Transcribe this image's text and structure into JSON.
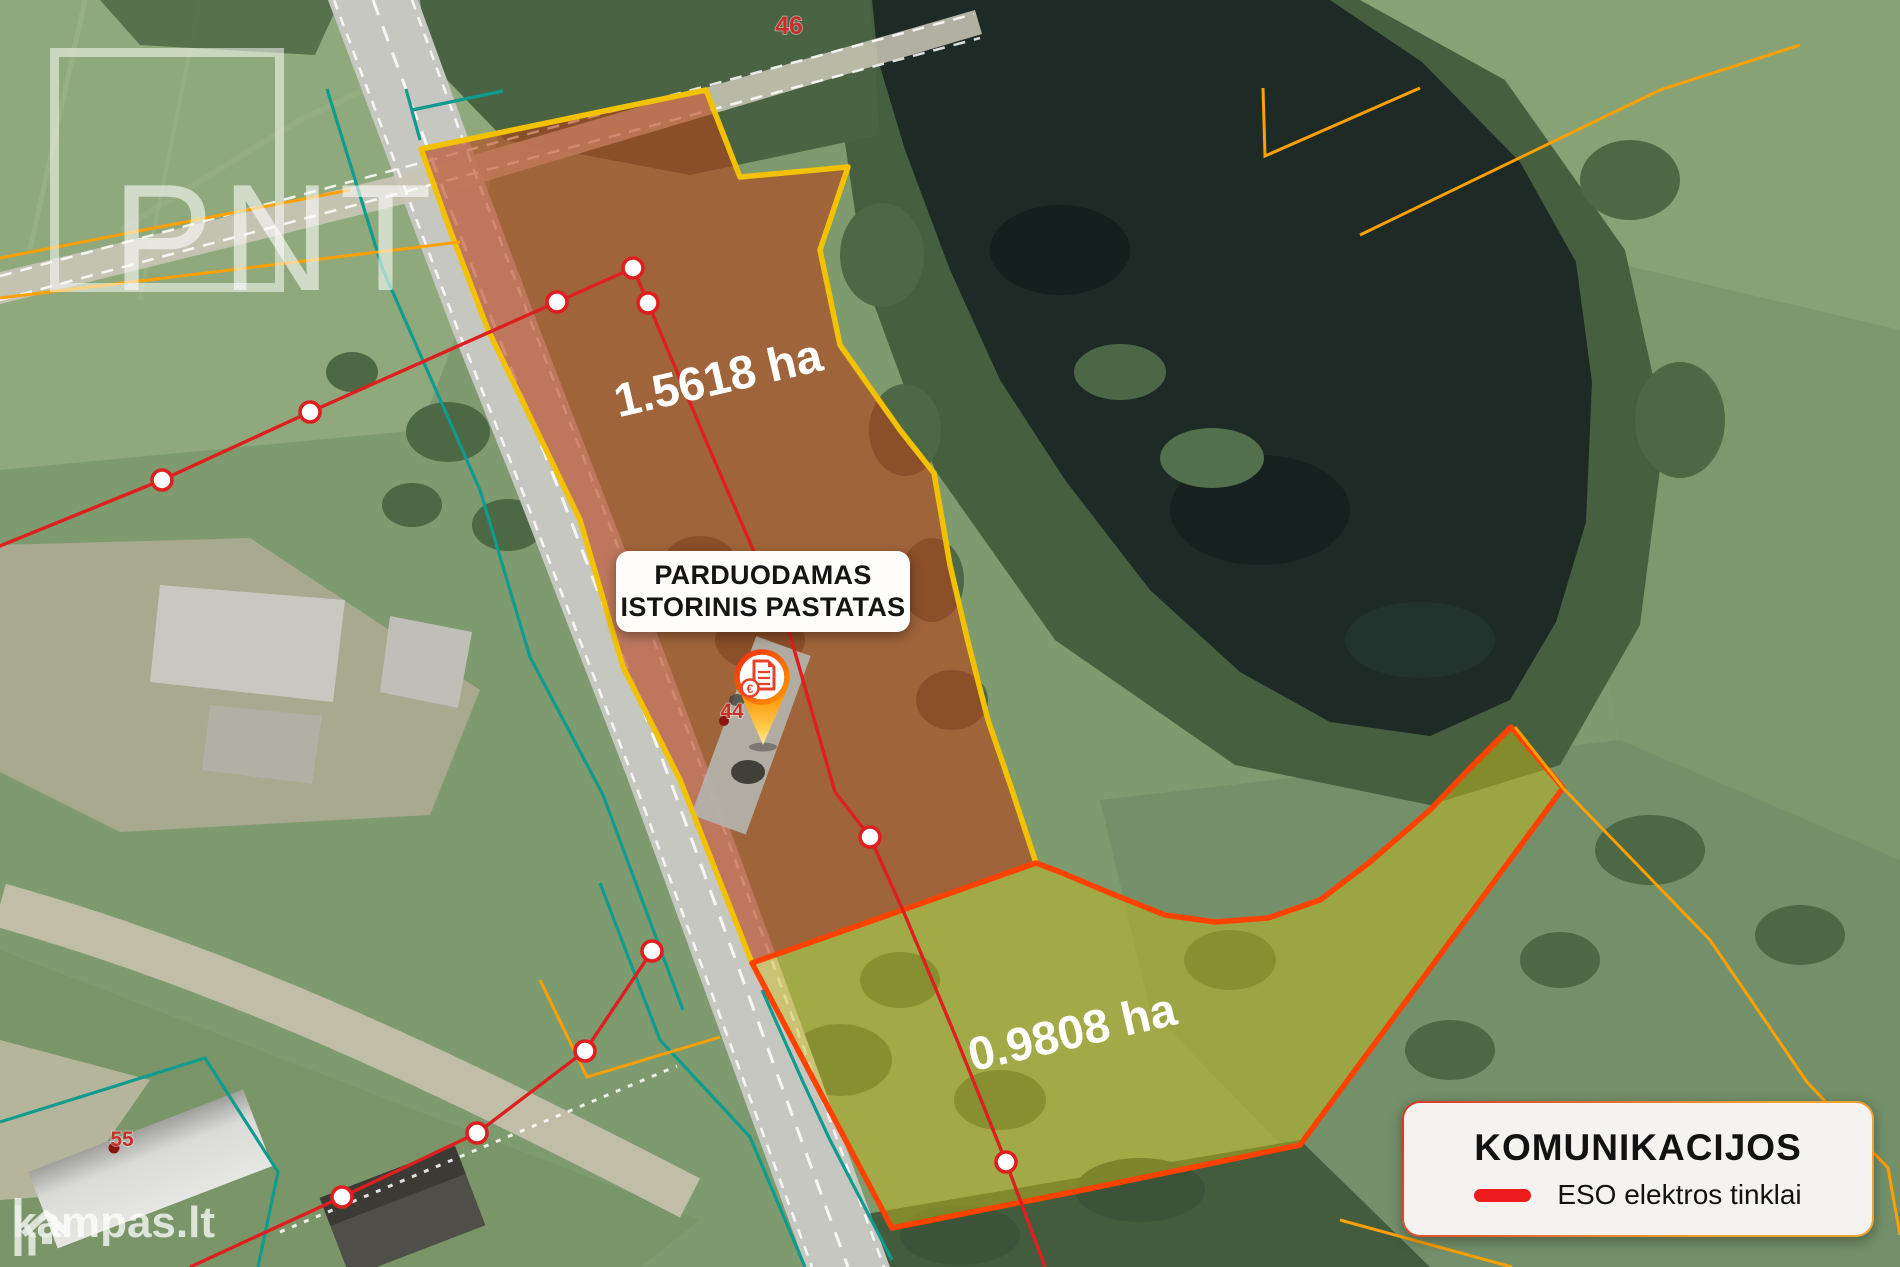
{
  "branding": {
    "watermark": "PNT",
    "site_logo": "kampas.lt"
  },
  "callout": {
    "line1": "PARDUODAMAS",
    "line2": "ISTORINIS PASTATAS"
  },
  "parcels": [
    {
      "name": "parcel-main",
      "area": "1.5618 ha",
      "fill": "#b93e14",
      "border": "#f2c200"
    },
    {
      "name": "parcel-secondary",
      "area": "0.9808 ha",
      "fill": "#cdbd1e",
      "border": "#ff4200"
    }
  ],
  "plot_numbers": [
    {
      "value": "46"
    },
    {
      "value": "44"
    },
    {
      "value": "55"
    }
  ],
  "pin": {
    "symbol": "€"
  },
  "legend": {
    "title": "KOMUNIKACIJOS",
    "items": [
      {
        "label": "ESO elektros tinklai",
        "color": "#ee1c1c"
      }
    ]
  },
  "colors": {
    "power-line": "#dd1f1f",
    "cadastral-teal": "#0f9b8e",
    "cadastral-orange": "#ffa000",
    "water": "#1d2a26",
    "road": "#c7c7c2"
  }
}
